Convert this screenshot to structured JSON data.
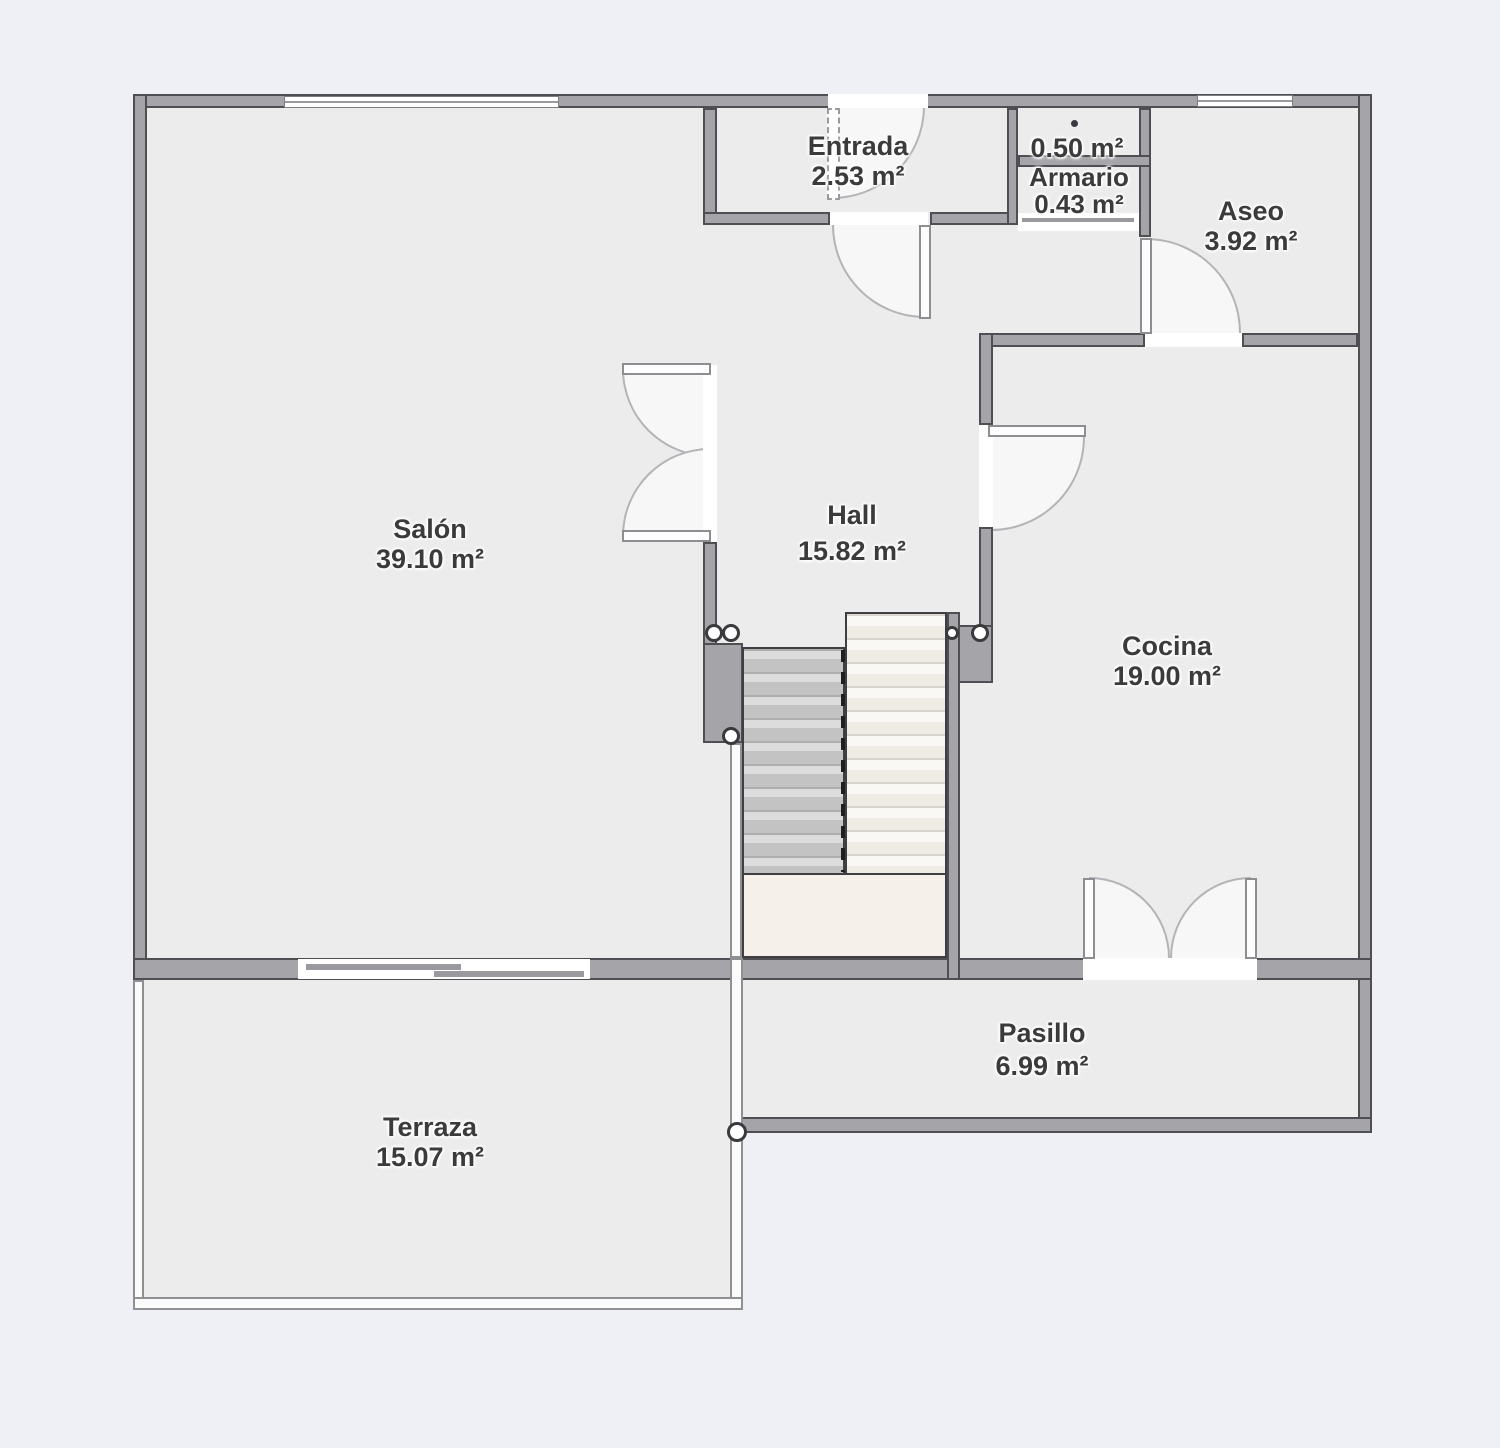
{
  "plan": {
    "title": "Planta baja - plano de vivienda",
    "colors": {
      "background": "#eef0f6",
      "floor": "#ececec",
      "wall": "#a5a5a9",
      "wall_edge": "#4f4f53",
      "stair_landing": "#f5f1ea",
      "label_text": "#3b3b3b"
    },
    "rooms": {
      "salon": {
        "name": "Salón",
        "area": "39.10 m²"
      },
      "hall": {
        "name": "Hall",
        "area": "15.82 m²"
      },
      "cocina": {
        "name": "Cocina",
        "area": "19.00 m²"
      },
      "entrada": {
        "name": "Entrada",
        "area": "2.53 m²"
      },
      "closet_small": {
        "name": "",
        "area": "0.50 m²"
      },
      "armario": {
        "name": "Armario",
        "area": "0.43 m²"
      },
      "aseo": {
        "name": "Aseo",
        "area": "3.92 m²"
      },
      "pasillo": {
        "name": "Pasillo",
        "area": "6.99 m²"
      },
      "terraza": {
        "name": "Terraza",
        "area": "15.07 m²"
      }
    }
  }
}
